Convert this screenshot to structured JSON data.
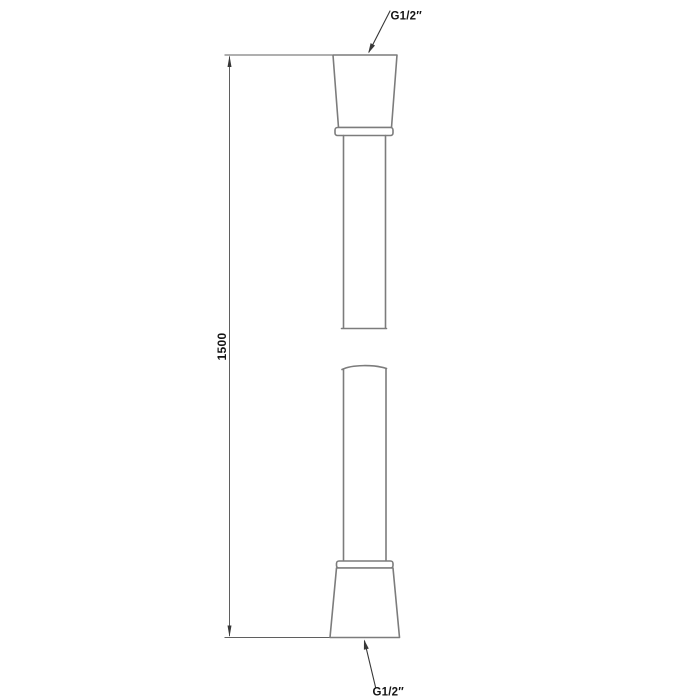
{
  "drawing": {
    "type": "technical-dimension-drawing",
    "subject": "shower-hose",
    "labels": {
      "top_thread": "G1/2″",
      "bottom_thread": "G1/2″",
      "length": "1500"
    },
    "colors": {
      "outline": "#7c7c7c",
      "dimension": "#5f5f5f",
      "leader": "#383838",
      "text": "#141414",
      "background": "#ffffff"
    }
  }
}
